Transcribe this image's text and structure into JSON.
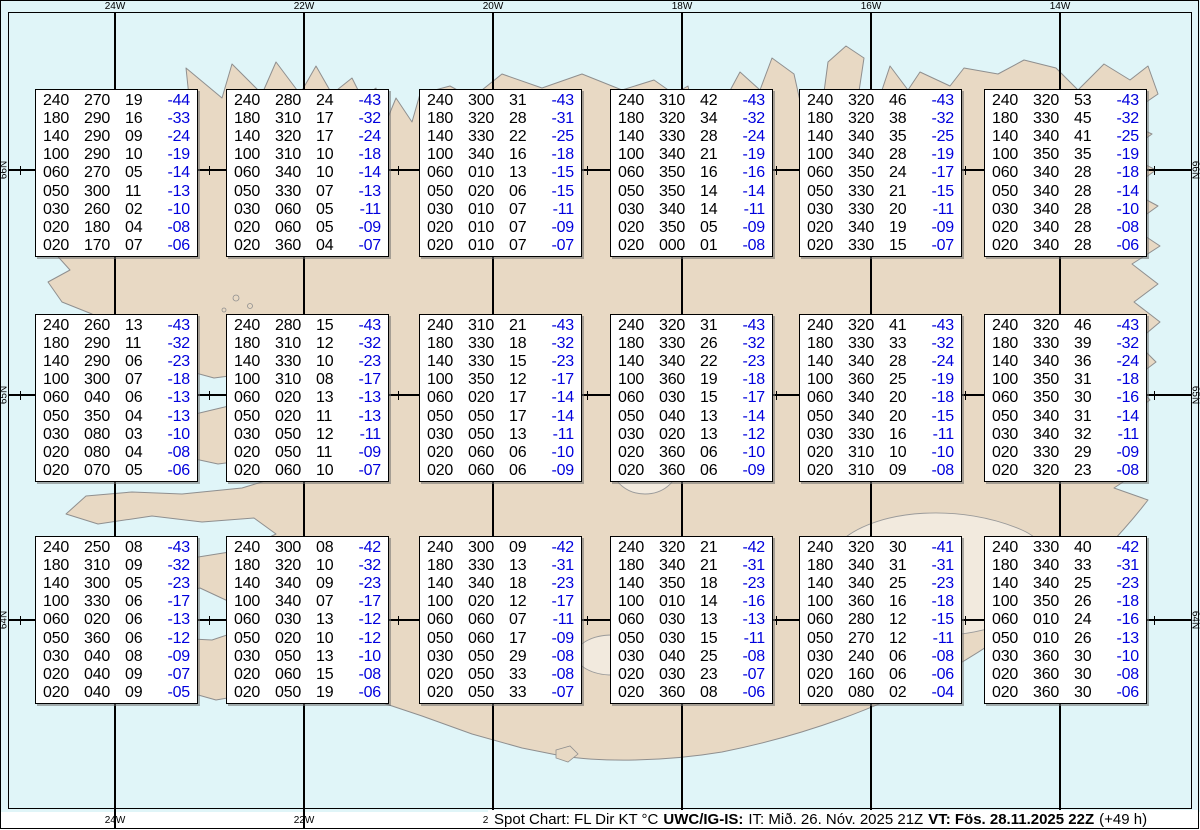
{
  "footer": {
    "chart_title": "Spot Chart: FL Dir KT °C",
    "source": "UWC/IG-IS:",
    "issue_time": "IT: Mið. 26. Nóv. 2025 21Z",
    "valid_time": "VT: Fös. 28.11.2025 22Z",
    "lead_time": "(+49 h)"
  },
  "colors": {
    "temperature_text": "#0000dd",
    "ocean": "#e0f5f8",
    "land": "#e8d9c4",
    "grid": "#000000"
  },
  "map": {
    "top_lon_labels": [
      "24W",
      "22W",
      "20W",
      "18W",
      "16W",
      "14W"
    ],
    "bottom_lon_labels": [
      "24W",
      "22W",
      "20W"
    ],
    "left_lat_labels": [
      "66N",
      "65N",
      "64N"
    ],
    "right_lat_labels": [
      "66N",
      "65N",
      "64N"
    ]
  },
  "chart_data": {
    "type": "table",
    "title": "Spot Chart: FL Dir KT °C",
    "columns": [
      "FL",
      "Dir",
      "KT",
      "°C"
    ],
    "grid_lons": [
      "24W",
      "22W",
      "20W",
      "18W",
      "16W",
      "14W"
    ],
    "grid_lats": [
      "66N",
      "65N",
      "64N"
    ],
    "spots": [
      {
        "lat": "66N",
        "lon": "24W",
        "rows": [
          [
            "240",
            "270",
            "19",
            "-44"
          ],
          [
            "180",
            "290",
            "16",
            "-33"
          ],
          [
            "140",
            "290",
            "09",
            "-24"
          ],
          [
            "100",
            "290",
            "10",
            "-19"
          ],
          [
            "060",
            "270",
            "05",
            "-14"
          ],
          [
            "050",
            "300",
            "11",
            "-13"
          ],
          [
            "030",
            "260",
            "02",
            "-10"
          ],
          [
            "020",
            "180",
            "04",
            "-08"
          ],
          [
            "020",
            "170",
            "07",
            "-06"
          ]
        ]
      },
      {
        "lat": "66N",
        "lon": "22W",
        "rows": [
          [
            "240",
            "280",
            "24",
            "-43"
          ],
          [
            "180",
            "310",
            "17",
            "-32"
          ],
          [
            "140",
            "320",
            "17",
            "-24"
          ],
          [
            "100",
            "310",
            "10",
            "-18"
          ],
          [
            "060",
            "340",
            "10",
            "-14"
          ],
          [
            "050",
            "330",
            "07",
            "-13"
          ],
          [
            "030",
            "060",
            "05",
            "-11"
          ],
          [
            "020",
            "060",
            "05",
            "-09"
          ],
          [
            "020",
            "360",
            "04",
            "-07"
          ]
        ]
      },
      {
        "lat": "66N",
        "lon": "20W",
        "rows": [
          [
            "240",
            "300",
            "31",
            "-43"
          ],
          [
            "180",
            "320",
            "28",
            "-31"
          ],
          [
            "140",
            "330",
            "22",
            "-25"
          ],
          [
            "100",
            "340",
            "16",
            "-18"
          ],
          [
            "060",
            "010",
            "13",
            "-15"
          ],
          [
            "050",
            "020",
            "06",
            "-15"
          ],
          [
            "030",
            "010",
            "07",
            "-11"
          ],
          [
            "020",
            "010",
            "07",
            "-09"
          ],
          [
            "020",
            "010",
            "07",
            "-07"
          ]
        ]
      },
      {
        "lat": "66N",
        "lon": "18W",
        "rows": [
          [
            "240",
            "310",
            "42",
            "-43"
          ],
          [
            "180",
            "320",
            "34",
            "-32"
          ],
          [
            "140",
            "330",
            "28",
            "-24"
          ],
          [
            "100",
            "340",
            "21",
            "-19"
          ],
          [
            "060",
            "350",
            "16",
            "-16"
          ],
          [
            "050",
            "350",
            "14",
            "-14"
          ],
          [
            "030",
            "340",
            "14",
            "-11"
          ],
          [
            "020",
            "350",
            "05",
            "-09"
          ],
          [
            "020",
            "000",
            "01",
            "-08"
          ]
        ]
      },
      {
        "lat": "66N",
        "lon": "16W",
        "rows": [
          [
            "240",
            "320",
            "46",
            "-43"
          ],
          [
            "180",
            "320",
            "38",
            "-32"
          ],
          [
            "140",
            "340",
            "35",
            "-25"
          ],
          [
            "100",
            "340",
            "28",
            "-19"
          ],
          [
            "060",
            "350",
            "24",
            "-17"
          ],
          [
            "050",
            "330",
            "21",
            "-15"
          ],
          [
            "030",
            "330",
            "20",
            "-11"
          ],
          [
            "020",
            "340",
            "19",
            "-09"
          ],
          [
            "020",
            "330",
            "15",
            "-07"
          ]
        ]
      },
      {
        "lat": "66N",
        "lon": "14W",
        "rows": [
          [
            "240",
            "320",
            "53",
            "-43"
          ],
          [
            "180",
            "330",
            "45",
            "-32"
          ],
          [
            "140",
            "340",
            "41",
            "-25"
          ],
          [
            "100",
            "350",
            "35",
            "-19"
          ],
          [
            "060",
            "340",
            "28",
            "-18"
          ],
          [
            "050",
            "340",
            "28",
            "-14"
          ],
          [
            "030",
            "340",
            "28",
            "-10"
          ],
          [
            "020",
            "340",
            "28",
            "-08"
          ],
          [
            "020",
            "340",
            "28",
            "-06"
          ]
        ]
      },
      {
        "lat": "65N",
        "lon": "24W",
        "rows": [
          [
            "240",
            "260",
            "13",
            "-43"
          ],
          [
            "180",
            "290",
            "11",
            "-32"
          ],
          [
            "140",
            "290",
            "06",
            "-23"
          ],
          [
            "100",
            "300",
            "07",
            "-18"
          ],
          [
            "060",
            "040",
            "06",
            "-13"
          ],
          [
            "050",
            "350",
            "04",
            "-13"
          ],
          [
            "030",
            "080",
            "03",
            "-10"
          ],
          [
            "020",
            "080",
            "04",
            "-08"
          ],
          [
            "020",
            "070",
            "05",
            "-06"
          ]
        ]
      },
      {
        "lat": "65N",
        "lon": "22W",
        "rows": [
          [
            "240",
            "280",
            "15",
            "-43"
          ],
          [
            "180",
            "310",
            "12",
            "-32"
          ],
          [
            "140",
            "330",
            "10",
            "-23"
          ],
          [
            "100",
            "310",
            "08",
            "-17"
          ],
          [
            "060",
            "020",
            "13",
            "-13"
          ],
          [
            "050",
            "020",
            "11",
            "-13"
          ],
          [
            "030",
            "050",
            "12",
            "-11"
          ],
          [
            "020",
            "050",
            "11",
            "-09"
          ],
          [
            "020",
            "060",
            "10",
            "-07"
          ]
        ]
      },
      {
        "lat": "65N",
        "lon": "20W",
        "rows": [
          [
            "240",
            "310",
            "21",
            "-43"
          ],
          [
            "180",
            "330",
            "18",
            "-32"
          ],
          [
            "140",
            "330",
            "15",
            "-23"
          ],
          [
            "100",
            "350",
            "12",
            "-17"
          ],
          [
            "060",
            "020",
            "17",
            "-14"
          ],
          [
            "050",
            "050",
            "17",
            "-14"
          ],
          [
            "030",
            "050",
            "13",
            "-11"
          ],
          [
            "020",
            "060",
            "06",
            "-10"
          ],
          [
            "020",
            "060",
            "06",
            "-09"
          ]
        ]
      },
      {
        "lat": "65N",
        "lon": "18W",
        "rows": [
          [
            "240",
            "320",
            "31",
            "-43"
          ],
          [
            "180",
            "330",
            "26",
            "-32"
          ],
          [
            "140",
            "340",
            "22",
            "-23"
          ],
          [
            "100",
            "360",
            "19",
            "-18"
          ],
          [
            "060",
            "030",
            "15",
            "-17"
          ],
          [
            "050",
            "040",
            "13",
            "-14"
          ],
          [
            "030",
            "020",
            "13",
            "-12"
          ],
          [
            "020",
            "360",
            "06",
            "-10"
          ],
          [
            "020",
            "360",
            "06",
            "-09"
          ]
        ]
      },
      {
        "lat": "65N",
        "lon": "16W",
        "rows": [
          [
            "240",
            "320",
            "41",
            "-43"
          ],
          [
            "180",
            "330",
            "33",
            "-32"
          ],
          [
            "140",
            "340",
            "28",
            "-24"
          ],
          [
            "100",
            "360",
            "25",
            "-19"
          ],
          [
            "060",
            "340",
            "20",
            "-18"
          ],
          [
            "050",
            "340",
            "20",
            "-15"
          ],
          [
            "030",
            "330",
            "16",
            "-11"
          ],
          [
            "020",
            "310",
            "10",
            "-10"
          ],
          [
            "020",
            "310",
            "09",
            "-08"
          ]
        ]
      },
      {
        "lat": "65N",
        "lon": "14W",
        "rows": [
          [
            "240",
            "320",
            "46",
            "-43"
          ],
          [
            "180",
            "330",
            "39",
            "-32"
          ],
          [
            "140",
            "340",
            "36",
            "-24"
          ],
          [
            "100",
            "350",
            "31",
            "-18"
          ],
          [
            "060",
            "350",
            "30",
            "-16"
          ],
          [
            "050",
            "340",
            "31",
            "-14"
          ],
          [
            "030",
            "340",
            "32",
            "-11"
          ],
          [
            "020",
            "330",
            "29",
            "-09"
          ],
          [
            "020",
            "320",
            "23",
            "-08"
          ]
        ]
      },
      {
        "lat": "64N",
        "lon": "24W",
        "rows": [
          [
            "240",
            "250",
            "08",
            "-43"
          ],
          [
            "180",
            "310",
            "09",
            "-32"
          ],
          [
            "140",
            "300",
            "05",
            "-23"
          ],
          [
            "100",
            "330",
            "06",
            "-17"
          ],
          [
            "060",
            "020",
            "06",
            "-13"
          ],
          [
            "050",
            "360",
            "06",
            "-12"
          ],
          [
            "030",
            "040",
            "08",
            "-09"
          ],
          [
            "020",
            "040",
            "09",
            "-07"
          ],
          [
            "020",
            "040",
            "09",
            "-05"
          ]
        ]
      },
      {
        "lat": "64N",
        "lon": "22W",
        "rows": [
          [
            "240",
            "300",
            "08",
            "-42"
          ],
          [
            "180",
            "320",
            "10",
            "-32"
          ],
          [
            "140",
            "340",
            "09",
            "-23"
          ],
          [
            "100",
            "340",
            "07",
            "-17"
          ],
          [
            "060",
            "030",
            "13",
            "-12"
          ],
          [
            "050",
            "020",
            "10",
            "-12"
          ],
          [
            "030",
            "050",
            "13",
            "-10"
          ],
          [
            "020",
            "060",
            "15",
            "-08"
          ],
          [
            "020",
            "050",
            "19",
            "-06"
          ]
        ]
      },
      {
        "lat": "64N",
        "lon": "20W",
        "rows": [
          [
            "240",
            "300",
            "09",
            "-42"
          ],
          [
            "180",
            "330",
            "13",
            "-31"
          ],
          [
            "140",
            "340",
            "18",
            "-23"
          ],
          [
            "100",
            "020",
            "12",
            "-17"
          ],
          [
            "060",
            "060",
            "07",
            "-11"
          ],
          [
            "050",
            "060",
            "17",
            "-09"
          ],
          [
            "030",
            "050",
            "29",
            "-08"
          ],
          [
            "020",
            "050",
            "33",
            "-08"
          ],
          [
            "020",
            "050",
            "33",
            "-07"
          ]
        ]
      },
      {
        "lat": "64N",
        "lon": "18W",
        "rows": [
          [
            "240",
            "320",
            "21",
            "-42"
          ],
          [
            "180",
            "340",
            "21",
            "-31"
          ],
          [
            "140",
            "350",
            "18",
            "-23"
          ],
          [
            "100",
            "010",
            "14",
            "-16"
          ],
          [
            "060",
            "030",
            "13",
            "-13"
          ],
          [
            "050",
            "030",
            "15",
            "-11"
          ],
          [
            "030",
            "040",
            "25",
            "-08"
          ],
          [
            "020",
            "030",
            "23",
            "-07"
          ],
          [
            "020",
            "360",
            "08",
            "-06"
          ]
        ]
      },
      {
        "lat": "64N",
        "lon": "16W",
        "rows": [
          [
            "240",
            "320",
            "30",
            "-41"
          ],
          [
            "180",
            "340",
            "31",
            "-31"
          ],
          [
            "140",
            "340",
            "25",
            "-23"
          ],
          [
            "100",
            "360",
            "16",
            "-18"
          ],
          [
            "060",
            "280",
            "12",
            "-15"
          ],
          [
            "050",
            "270",
            "12",
            "-11"
          ],
          [
            "030",
            "240",
            "06",
            "-08"
          ],
          [
            "020",
            "160",
            "06",
            "-06"
          ],
          [
            "020",
            "080",
            "02",
            "-04"
          ]
        ]
      },
      {
        "lat": "64N",
        "lon": "14W",
        "rows": [
          [
            "240",
            "330",
            "40",
            "-42"
          ],
          [
            "180",
            "340",
            "33",
            "-31"
          ],
          [
            "140",
            "340",
            "25",
            "-23"
          ],
          [
            "100",
            "350",
            "26",
            "-18"
          ],
          [
            "060",
            "010",
            "24",
            "-16"
          ],
          [
            "050",
            "010",
            "26",
            "-13"
          ],
          [
            "030",
            "360",
            "30",
            "-10"
          ],
          [
            "020",
            "360",
            "30",
            "-08"
          ],
          [
            "020",
            "360",
            "30",
            "-06"
          ]
        ]
      }
    ]
  }
}
